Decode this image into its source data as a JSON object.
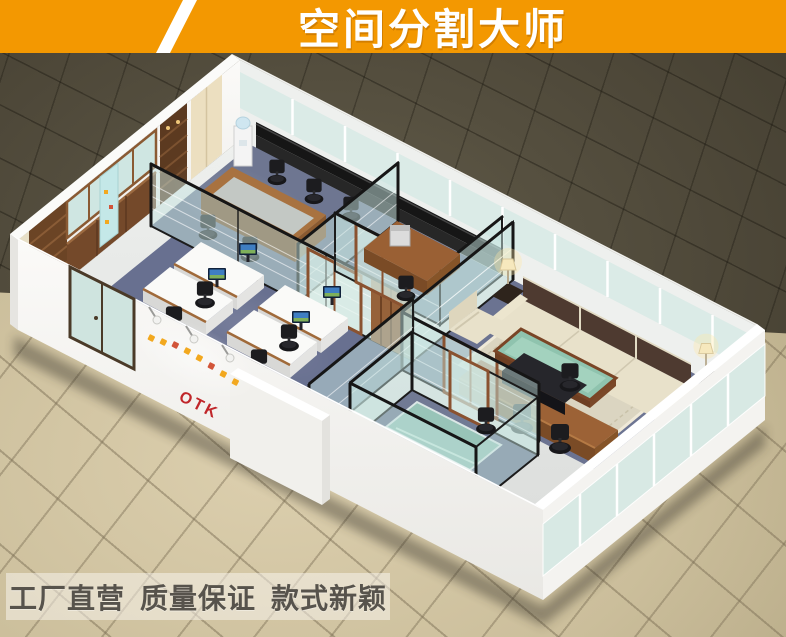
{
  "banner": {
    "title": "空间分割大师"
  },
  "logo_wall": {
    "brand": "OTK"
  },
  "footer": {
    "slogans": [
      "工厂直营",
      "质量保证",
      "款式新颖"
    ]
  },
  "colors": {
    "banner_orange": "#f39801",
    "slogan_text": "#57534c",
    "brand_red": "#c0262a",
    "logo_accent_orange": "#f2a81f",
    "glass_tint": "#cfe6e2",
    "partition_frame_black": "#1c1c1c",
    "door_frame_wood": "#8a5230",
    "carpet_blue_gray": "#687090",
    "furniture_wood": "#9a6034",
    "sofa_cream": "#e8e1ca",
    "sofa_cushion_brown": "#4e3a30",
    "coffee_table_glass_green": "#8fc3ae",
    "exterior_tile_beige": "#cfc3a2",
    "background_olive": "#4d4839"
  }
}
